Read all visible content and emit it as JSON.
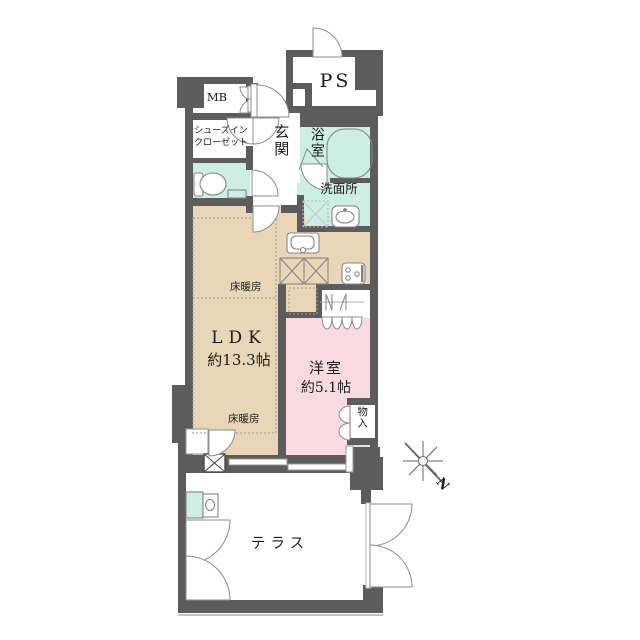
{
  "floor_plan": {
    "rooms": {
      "ps": "PS",
      "mb": "MB",
      "shoe_closet_line1": "シューズイン",
      "shoe_closet_line2": "クローゼット",
      "entrance": "玄関",
      "bathroom": "浴室",
      "washroom": "洗面所",
      "floor_heating_upper": "床暖房",
      "floor_heating_lower": "床暖房",
      "ldk_name": "LDK",
      "ldk_size": "約13.3帖",
      "western_room_name": "洋室",
      "western_room_size": "約5.1帖",
      "storage": "物入",
      "terrace": "テラス"
    },
    "compass": {
      "north_label": "N"
    },
    "colors": {
      "wall": "#5c5c5c",
      "water_rooms": "#cdeee2",
      "living_dining": "#e9d6b6",
      "bedroom": "#f9d9e2",
      "door_line": "#8c8c8c"
    },
    "icons": [
      "toilet-icon",
      "bathtub-icon",
      "washbasin-icon",
      "washing-machine-pan-icon",
      "kitchen-sink-icon",
      "counter-icon",
      "stove-icon",
      "fridge-space-icon",
      "hanger-pipe-icon",
      "slop-sink-icon",
      "duct-icon",
      "compass-star-icon"
    ]
  }
}
